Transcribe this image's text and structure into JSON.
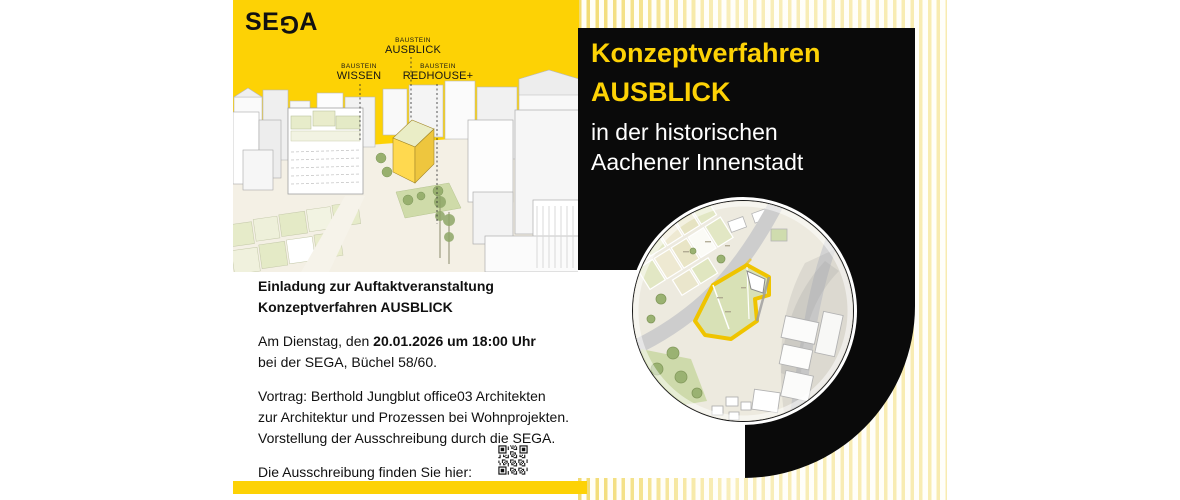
{
  "brand": {
    "logo": "SE",
    "logo_flipped_letter": "G",
    "logo_end": "A",
    "yellow": "#fdd205",
    "black": "#0a0a0a",
    "stripe_yellow": "#f0d65e"
  },
  "hero": {
    "labels": [
      {
        "eyebrow": "BAUSTEIN",
        "name": "AUSBLICK"
      },
      {
        "eyebrow": "BAUSTEIN",
        "name": "WISSEN"
      },
      {
        "eyebrow": "BAUSTEIN",
        "name": "REDHOUSE+"
      }
    ]
  },
  "title": {
    "line1": "Konzeptverfahren",
    "line2": "AUSBLICK",
    "line3": "in der historischen",
    "line4": "Aachener Innenstadt"
  },
  "body": {
    "heading1": "Einladung zur Auftaktveranstaltung",
    "heading2": "Konzeptverfahren AUSBLICK",
    "date_prefix": "Am Dienstag, den ",
    "date_bold": "20.01.2026 um 18:00 Uhr",
    "location": "bei der SEGA, Büchel 58/60.",
    "talk1": "Vortrag: Berthold Jungblut office03 Architekten",
    "talk2": "zur Architektur und Prozessen bei Wohnprojekten.",
    "talk3": "Vorstellung der Ausschreibung durch die SEGA.",
    "cta": "Die Ausschreibung finden Sie hier:"
  }
}
